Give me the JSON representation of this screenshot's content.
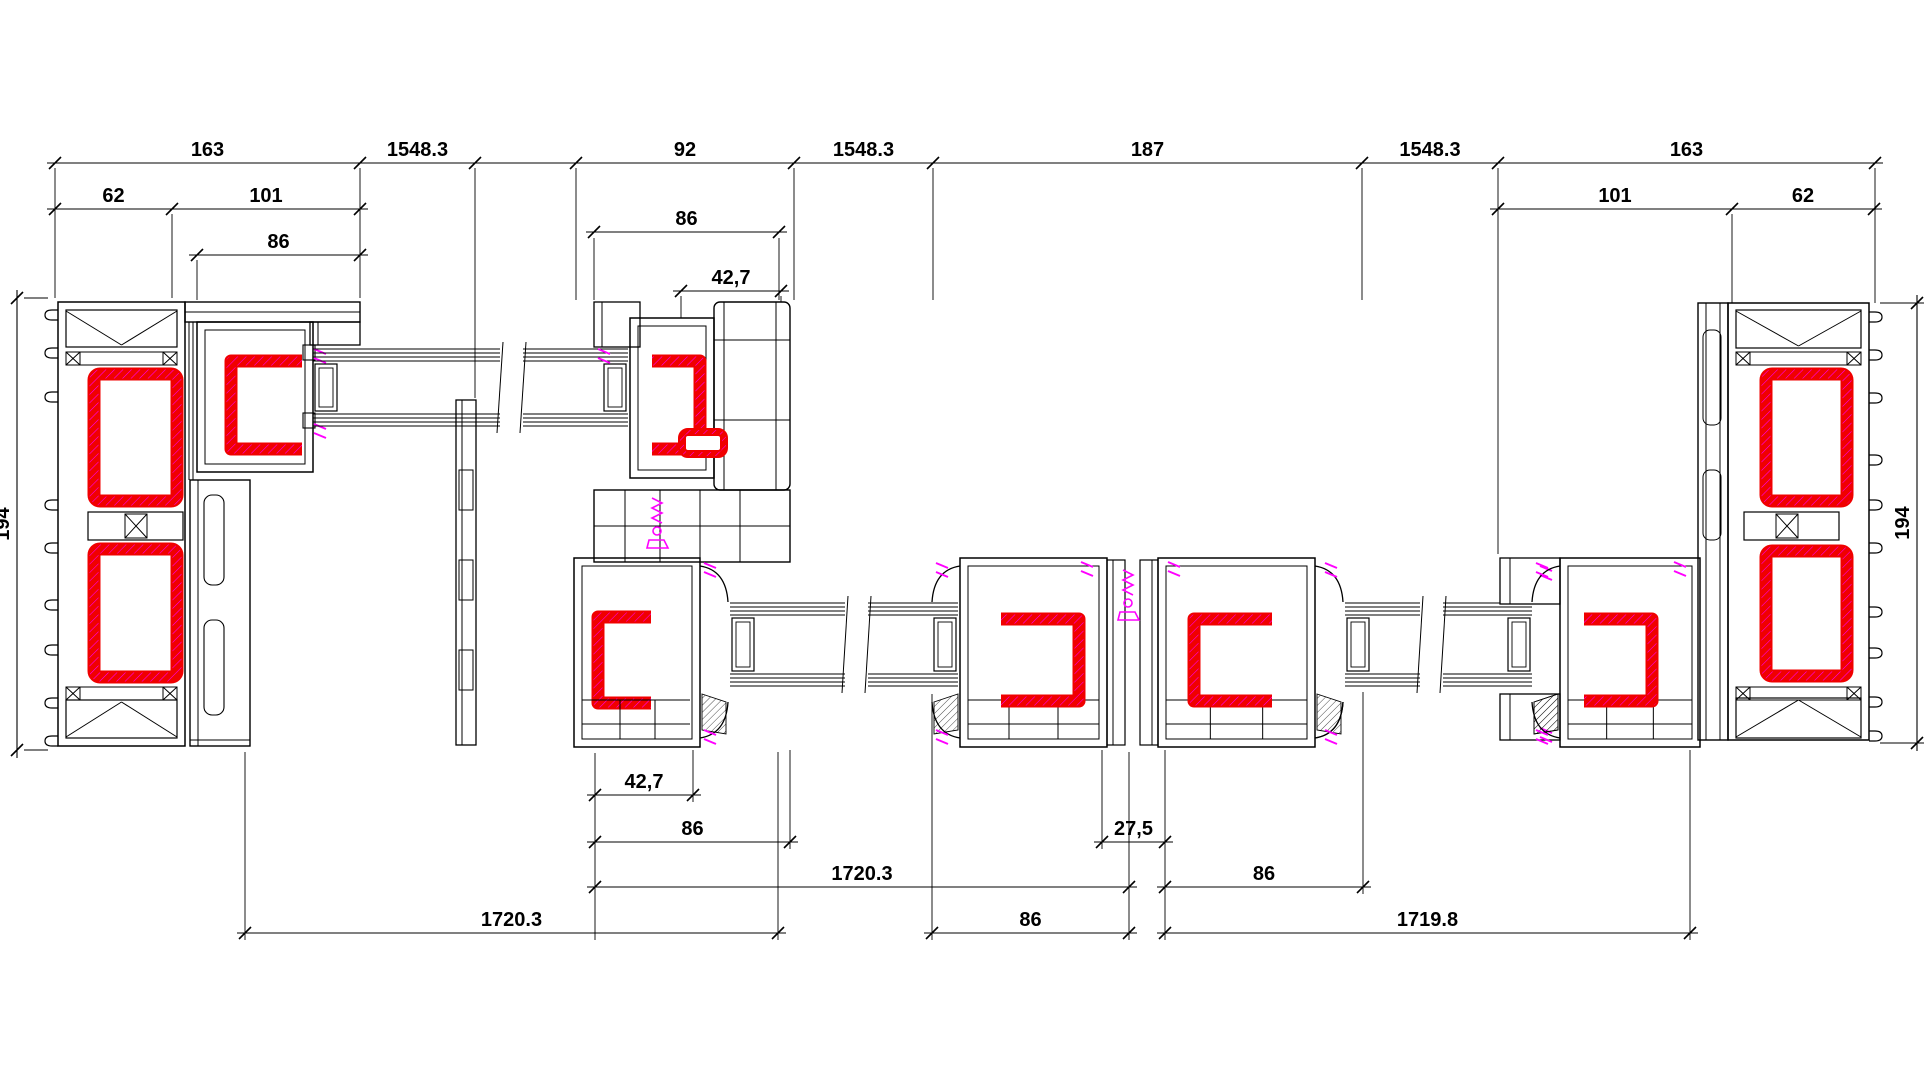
{
  "drawing": {
    "type": "window-profile-plan-section",
    "canvas": {
      "width": 1927,
      "height": 1084,
      "background": "#ffffff"
    },
    "colors": {
      "outline": "#000000",
      "steel_reinforcement": "#f00000",
      "gasket_hardware": "#ff00ff",
      "dimension": "#000000"
    },
    "dimension_rows": [
      {
        "y": 163,
        "segments": [
          [
            47,
            1883
          ]
        ],
        "ticks": [
          55,
          360,
          475,
          576,
          794,
          933,
          1362,
          1498,
          1875
        ],
        "labels": [
          {
            "x1": 55,
            "x2": 360,
            "text": "163"
          },
          {
            "x1": 360,
            "x2": 475,
            "text": "1548.3"
          },
          {
            "x1": 576,
            "x2": 794,
            "text": "92"
          },
          {
            "x1": 794,
            "x2": 933,
            "text": "1548.3"
          },
          {
            "x1": 933,
            "x2": 1362,
            "text": "187"
          },
          {
            "x1": 1362,
            "x2": 1498,
            "text": "1548.3"
          },
          {
            "x1": 1498,
            "x2": 1875,
            "text": "163"
          }
        ]
      },
      {
        "y": 209,
        "segments": [
          [
            47,
            368
          ],
          [
            1490,
            1882
          ]
        ],
        "ticks": [
          55,
          172,
          360,
          1498,
          1732,
          1874
        ],
        "labels": [
          {
            "x1": 55,
            "x2": 172,
            "text": "62"
          },
          {
            "x1": 172,
            "x2": 360,
            "text": "101"
          },
          {
            "x1": 1498,
            "x2": 1732,
            "text": "101"
          },
          {
            "x1": 1732,
            "x2": 1874,
            "text": "62"
          }
        ]
      },
      {
        "y": 232,
        "segments": [
          [
            586,
            787
          ]
        ],
        "ticks": [
          594,
          779
        ],
        "labels": [
          {
            "x1": 594,
            "x2": 779,
            "text": "86"
          }
        ]
      },
      {
        "y": 255,
        "segments": [
          [
            189,
            368
          ]
        ],
        "ticks": [
          197,
          360
        ],
        "labels": [
          {
            "x1": 197,
            "x2": 360,
            "text": "86"
          }
        ]
      },
      {
        "y": 291,
        "segments": [
          [
            673,
            789
          ]
        ],
        "ticks": [
          681,
          781
        ],
        "labels": [
          {
            "x1": 681,
            "x2": 781,
            "text": "42,7"
          }
        ]
      },
      {
        "y": 795,
        "segments": [
          [
            587,
            701
          ]
        ],
        "ticks": [
          595,
          693
        ],
        "labels": [
          {
            "x1": 595,
            "x2": 693,
            "text": "42,7"
          }
        ]
      },
      {
        "y": 842,
        "segments": [
          [
            587,
            798
          ],
          [
            1094,
            1173
          ]
        ],
        "ticks": [
          595,
          790,
          1102,
          1165
        ],
        "labels": [
          {
            "x1": 595,
            "x2": 790,
            "text": "86"
          },
          {
            "x1": 1102,
            "x2": 1165,
            "text": "27,5"
          }
        ]
      },
      {
        "y": 887,
        "segments": [
          [
            587,
            1137
          ],
          [
            1157,
            1371
          ]
        ],
        "ticks": [
          595,
          1129,
          1165,
          1363
        ],
        "labels": [
          {
            "x1": 595,
            "x2": 1129,
            "text": "1720.3"
          },
          {
            "x1": 1165,
            "x2": 1363,
            "text": "86"
          }
        ]
      },
      {
        "y": 933,
        "segments": [
          [
            237,
            786
          ],
          [
            924,
            1137
          ],
          [
            1157,
            1698
          ]
        ],
        "ticks": [
          245,
          778,
          932,
          1129,
          1165,
          1690
        ],
        "labels": [
          {
            "x1": 245,
            "x2": 778,
            "text": "1720.3"
          },
          {
            "x1": 932,
            "x2": 1129,
            "text": "86"
          },
          {
            "x1": 1165,
            "x2": 1690,
            "text": "1719.8"
          }
        ]
      }
    ],
    "vertical_dimensions": [
      {
        "x": 17,
        "y1": 298,
        "y2": 750,
        "text": "194"
      },
      {
        "x": 1917,
        "y1": 303,
        "y2": 743,
        "text": "194"
      }
    ],
    "extension_lines": [
      [
        55,
        168,
        298
      ],
      [
        172,
        214,
        298
      ],
      [
        197,
        260,
        300
      ],
      [
        360,
        168,
        298
      ],
      [
        475,
        168,
        398
      ],
      [
        576,
        168,
        300
      ],
      [
        594,
        238,
        300
      ],
      [
        779,
        238,
        300
      ],
      [
        681,
        296,
        318
      ],
      [
        781,
        296,
        302
      ],
      [
        794,
        168,
        300
      ],
      [
        933,
        168,
        300
      ],
      [
        1362,
        168,
        300
      ],
      [
        1498,
        168,
        554
      ],
      [
        1732,
        214,
        303
      ],
      [
        1875,
        168,
        303
      ],
      [
        245,
        752,
        940
      ],
      [
        595,
        753,
        940
      ],
      [
        693,
        750,
        802
      ],
      [
        778,
        752,
        940
      ],
      [
        790,
        750,
        849
      ],
      [
        932,
        694,
        940
      ],
      [
        1102,
        750,
        849
      ],
      [
        1129,
        752,
        940
      ],
      [
        1165,
        750,
        940
      ],
      [
        1363,
        692,
        894
      ],
      [
        1690,
        750,
        940
      ]
    ],
    "extension_lines_h": [
      [
        298,
        24,
        48
      ],
      [
        750,
        24,
        48
      ],
      [
        303,
        1880,
        1924
      ],
      [
        743,
        1880,
        1924
      ]
    ]
  }
}
